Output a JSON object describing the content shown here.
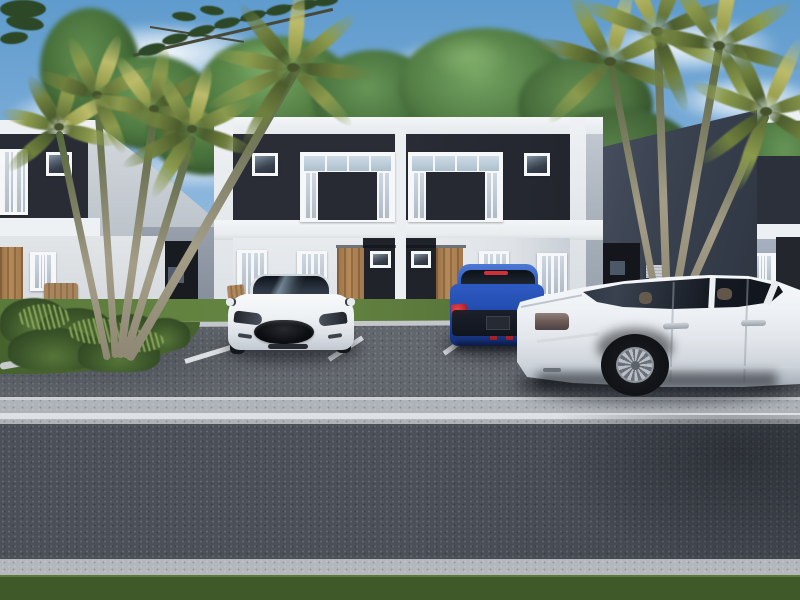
{
  "scene": {
    "type": "3d-architectural-rendering",
    "setting": "Modern two-story duplex townhome complex exterior with front parking lot, street and tropical landscaping",
    "time_of_day": "daytime",
    "weather": "sunny with scattered white clouds",
    "visible_text": "none"
  },
  "buildings": {
    "center_duplex": {
      "description": "mirrored two-unit duplex, white parapet frame wrapping dark charcoal upper panels",
      "units": 2,
      "upper_floor": {
        "panel_color": "#2a2d35",
        "windows_per_unit": [
          "small square window",
          "large window assembly with curtained side lights, clerestory row and dark center inset"
        ]
      },
      "ground_floor": {
        "wall_color": "#e5e8eb",
        "entry_doors": 2,
        "door_color": "#ae8354",
        "door_surrounds": "dark charcoal panels each with a small window",
        "curtained_windows_per_unit": 2
      }
    },
    "left_building": {
      "description": "identical neighboring duplex seen partially at left edge",
      "features": [
        "dark upper accent panel",
        "curtained windows",
        "wood entry door",
        "gray side wing with recessed dark doorway",
        "wood bench"
      ]
    },
    "right_building": {
      "description": "identical neighboring duplex seen partially at right edge",
      "features": [
        "dark upper accent panel",
        "white trim bands",
        "curtained windows",
        "gray side wing with recessed doorway and wall AC unit"
      ]
    }
  },
  "vehicles": [
    {
      "name": "white-sedan-front-view",
      "style": "Tesla-like fastback",
      "view": "front",
      "color": "#f2f4f6",
      "details": [
        "black oval grille",
        "tinted panoramic windshield",
        "slim headlights",
        "side mirrors"
      ]
    },
    {
      "name": "blue-hatchback-rear-view",
      "view": "rear",
      "color": "#1e4aa8",
      "details": [
        "dark tinted rear window",
        "red tail lights",
        "high-mount stop lamp",
        "black lower bumper band",
        "license plate"
      ]
    },
    {
      "name": "white-luxury-sedan-side-view",
      "style": "Audi A8-like",
      "view": "rear three-quarter, facing left",
      "color": "#f0f2f4",
      "details": [
        "multi-spoke alloy wheel",
        "chrome rocker and trunk trim",
        "tinted windows",
        "door handles",
        "tail light"
      ]
    }
  ],
  "landscaping": {
    "palm_clusters": [
      {
        "position": "left of center duplex",
        "trunks": 5,
        "frond_color": "#8b9a4c"
      },
      {
        "position": "right of center duplex",
        "trunks": 4,
        "frond_color": "#8b9a4c"
      }
    ],
    "background_trees": "dense green tree line behind all buildings",
    "foreground": [
      "grass strip at building bases",
      "curbed planting bed with spiky shrubs lower-left",
      "wooden chair behind white car",
      "mown lawn strip at street edge"
    ]
  },
  "ground": {
    "areas": [
      "asphalt parking apron",
      "concrete sidewalk band with painted white edge line",
      "asphalt street",
      "concrete curb",
      "front lawn"
    ],
    "parking_lines": 3,
    "parking_line_color": "#e8ebee"
  },
  "palette": {
    "sky_top": "#5f9bcd",
    "sky_horizon": "#dde9f4",
    "cloud": "#ffffff",
    "tree_green": "#4f7a43",
    "palm_frond_olive": "#8b9a4c",
    "palm_trunk": "#9b9483",
    "building_white": "#eef0f2",
    "accent_panel_dark": "#2a2d35",
    "side_wall_gray": "#98a0ac",
    "wing_dark_slate": "#3a4250",
    "door_wood": "#ae8354",
    "window_frame": "#f5f7f9",
    "curtain_glass": "#b9c4cf",
    "asphalt_parking": "#62666d",
    "asphalt_road": "#4c5058",
    "concrete_curb": "#b2b6bc",
    "white_line": "#e6e9ec",
    "grass_strip": "#5d7c3d",
    "front_lawn": "#3f5a28",
    "car_blue": "#1e4aa8",
    "car_white": "#f2f4f6",
    "tail_light_red": "#c0252a",
    "grille_black": "#0b0d10"
  }
}
